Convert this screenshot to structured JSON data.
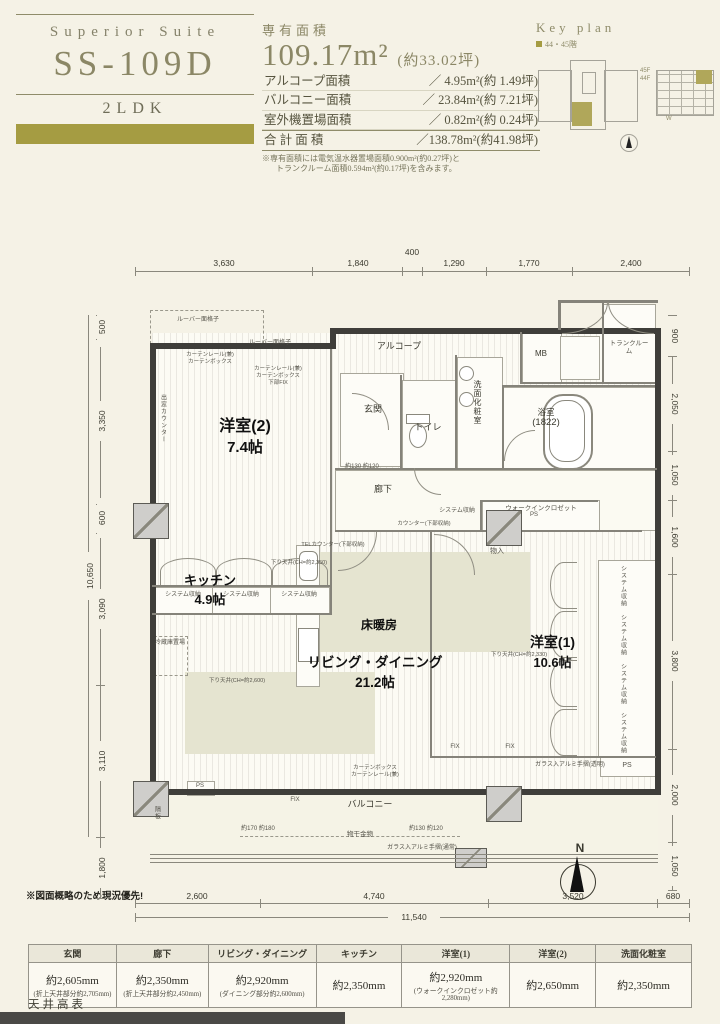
{
  "header": {
    "title_block": {
      "series": "Superior Suite",
      "unit": "SS-109D",
      "layout": "2LDK",
      "accent": "#a59c42"
    },
    "area": {
      "label": "専有面積",
      "main": "109.17m²",
      "main_tsubo": "(約33.02坪)",
      "rows": [
        {
          "name": "アルコープ面積",
          "value": "／  4.95m²(約 1.49坪)"
        },
        {
          "name": "バルコニー面積",
          "value": "／ 23.84m²(約 7.21坪)"
        },
        {
          "name": "室外機置場面積",
          "value": "／  0.82m²(約 0.24坪)"
        },
        {
          "name": "合 計 面 積",
          "value": "／138.78m²(約41.98坪)"
        }
      ],
      "note1": "※専有面積には電気温水器置場面積0.900m²(約0.27坪)と",
      "note2": "トランクルーム面積0.594m²(約0.17坪)を含みます。"
    },
    "key_plan": {
      "label": "Key plan",
      "floors": "44・45階",
      "f45": "45F",
      "f44": "44F",
      "w": "W"
    }
  },
  "plan": {
    "rooms": {
      "bed2": {
        "name": "洋室(2)",
        "size": "7.4帖"
      },
      "kitchen": {
        "name": "キッチン",
        "size": "4.9帖"
      },
      "living": {
        "name": "リビング・ダイニング",
        "size": "21.2帖"
      },
      "bed1": {
        "name": "洋室(1)",
        "size": "10.6帖"
      },
      "heat": "床暖房",
      "alcove": "アルコープ",
      "genkan": "玄関",
      "toilet": "トイレ",
      "wash": "洗面化粧室",
      "bath": "浴室",
      "bath_no": "(1822)",
      "mb": "MB",
      "trunk": "トランクルーム",
      "hall": "廊下",
      "balcony": "バルコニー",
      "wic": "ウォークインクロゼット",
      "mono": "物入"
    },
    "labels": {
      "sys": "システム収納",
      "ps": "PS",
      "fix": "FIX",
      "louver": "ルーバー面格子",
      "curtain_box": "カーテンボックス",
      "curtain_rail": "カーテンレール(兼)",
      "curtain_fix": "下部FIX",
      "demado": "出窓カウンター",
      "fridge": "冷蔵庫置場",
      "counter": "カウンター(下部収納)",
      "tel": "TELカウンター(下部収納)",
      "drop_a": "下り天井(CH=約2,350)",
      "drop_b": "下り天井(CH=約2,600)",
      "drop_c": "下り天井(CH=約2,330)",
      "monohoshi": "物干金物",
      "rail_normal": "ガラス入アルミ手摺(通常)",
      "rail_clear": "ガラス入アルミ手摺(透明)",
      "sekiban": "隔板",
      "note": "※図面概略のため現況優先!",
      "compass_n": "N",
      "pair_a": "約170  約180",
      "pair_b": "約130  約120"
    },
    "dims": {
      "top": [
        "3,630",
        "1,840",
        "400",
        "1,290",
        "1,770",
        "2,400"
      ],
      "left": [
        "500",
        "3,350",
        "600",
        "3,090",
        "3,110"
      ],
      "left_total": "10,650",
      "left_lower": "1,800",
      "right": [
        "900",
        "2,050",
        "1,050",
        "1,600",
        "3,800",
        "2,000",
        "1,050"
      ],
      "bottom": [
        "2,600",
        "4,740",
        "3,520",
        "680"
      ],
      "bottom_total": "11,540"
    }
  },
  "table": {
    "title": "天井高表",
    "columns": [
      "玄関",
      "廊下",
      "リビング・ダイニング",
      "キッチン",
      "洋室(1)",
      "洋室(2)",
      "洗面化粧室"
    ],
    "values": [
      "約2,605mm",
      "約2,350mm",
      "約2,920mm",
      "約2,350mm",
      "約2,920mm",
      "約2,650mm",
      "約2,350mm"
    ],
    "notes": [
      "(折上天井部分約2,705mm)",
      "(折上天井部分約2,450mm)",
      "(ダイニング部分約2,600mm)",
      "",
      "(ウォークインクロゼット約2,280mm)",
      "",
      ""
    ]
  }
}
